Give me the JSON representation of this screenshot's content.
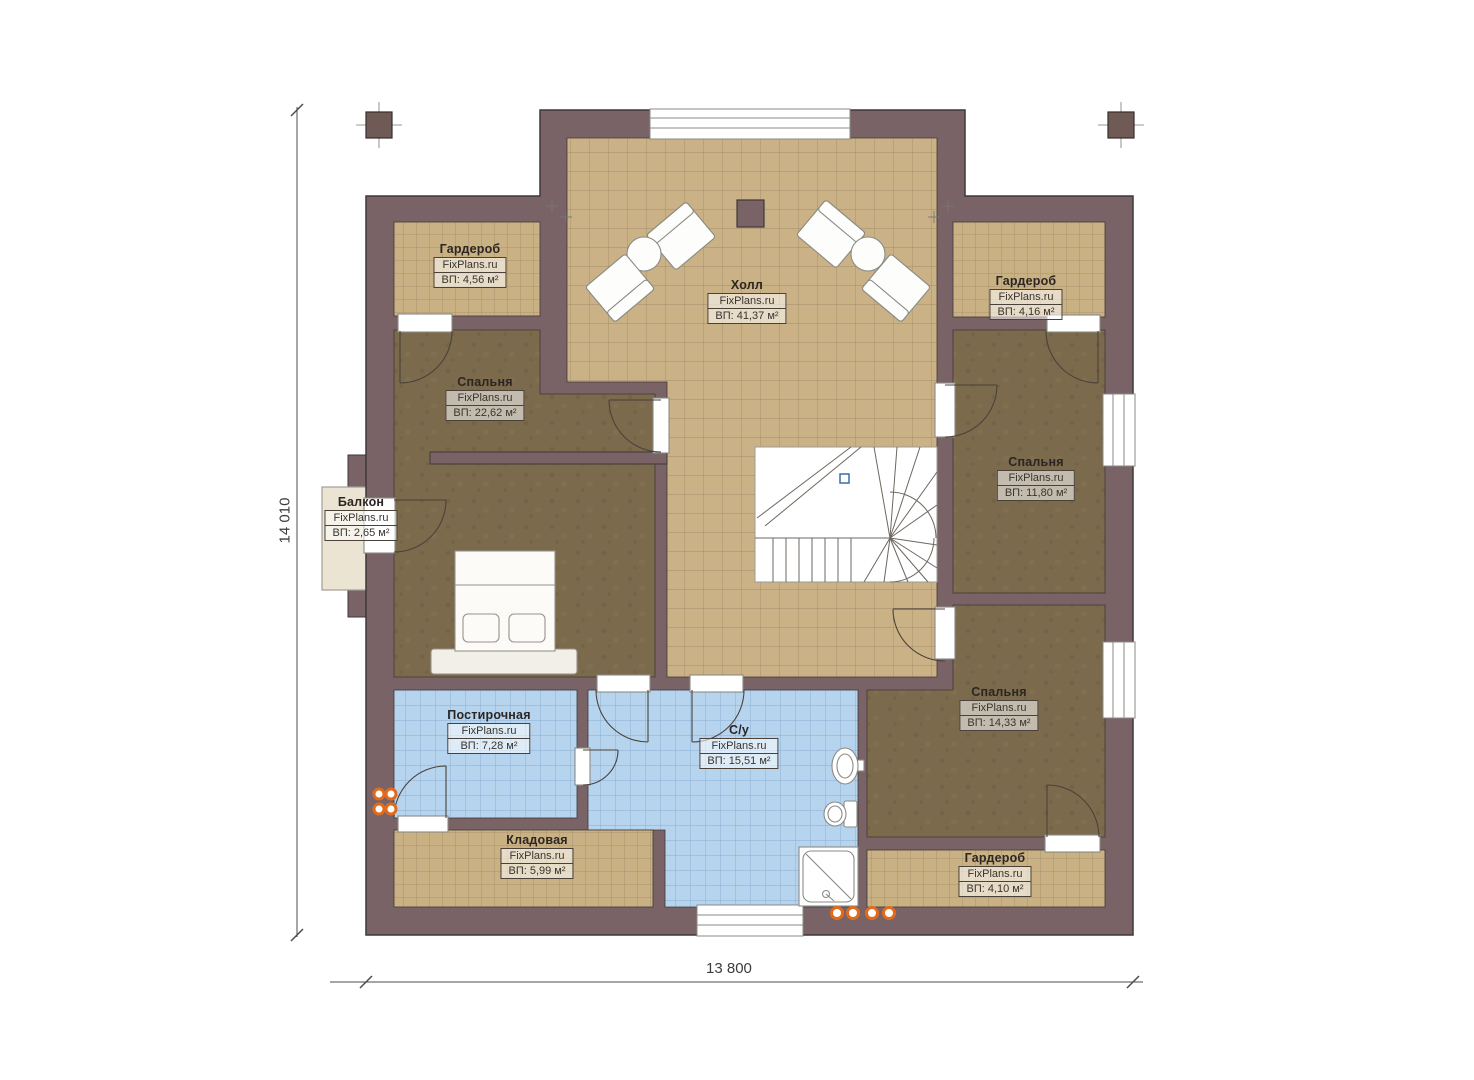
{
  "plan": {
    "dimensions": {
      "left": "14 010",
      "bottom": "13 800"
    },
    "rooms": [
      {
        "id": "wardrobe-top-left",
        "name": "Гардероб",
        "watermark": "FixPlans.ru",
        "area": "ВП: 4,56 м²"
      },
      {
        "id": "hall",
        "name": "Холл",
        "watermark": "FixPlans.ru",
        "area": "ВП: 41,37 м²"
      },
      {
        "id": "wardrobe-top-right",
        "name": "Гардероб",
        "watermark": "FixPlans.ru",
        "area": "ВП: 4,16 м²"
      },
      {
        "id": "bedroom-left",
        "name": "Спальня",
        "watermark": "FixPlans.ru",
        "area": "ВП: 22,62 м²"
      },
      {
        "id": "balcony",
        "name": "Балкон",
        "watermark": "FixPlans.ru",
        "area": "ВП: 2,65 м²"
      },
      {
        "id": "bedroom-right",
        "name": "Спальня",
        "watermark": "FixPlans.ru",
        "area": "ВП: 11,80 м²"
      },
      {
        "id": "bedroom-bottom-right",
        "name": "Спальня",
        "watermark": "FixPlans.ru",
        "area": "ВП: 14,33 м²"
      },
      {
        "id": "laundry",
        "name": "Постирочная",
        "watermark": "FixPlans.ru",
        "area": "ВП: 7,28 м²"
      },
      {
        "id": "bathroom",
        "name": "С/у",
        "watermark": "FixPlans.ru",
        "area": "ВП: 15,51 м²"
      },
      {
        "id": "storage",
        "name": "Кладовая",
        "watermark": "FixPlans.ru",
        "area": "ВП: 5,99 м²"
      },
      {
        "id": "wardrobe-bottom-right",
        "name": "Гардероб",
        "watermark": "FixPlans.ru",
        "area": "ВП: 4,10 м²"
      }
    ],
    "colors": {
      "wall": "#7a6366",
      "wall_outline": "#3f3839",
      "tile_floor": "#cbb286",
      "tile_grid": "#8d7c5f",
      "bedroom_floor": "#7b6a4c",
      "wet_floor": "#b7d4ef",
      "wet_grid": "#7fa3cc",
      "balcony_floor": "#ebe4d3",
      "radiator": "#e06b1c",
      "stair_marker": "#3a6ea8"
    }
  }
}
